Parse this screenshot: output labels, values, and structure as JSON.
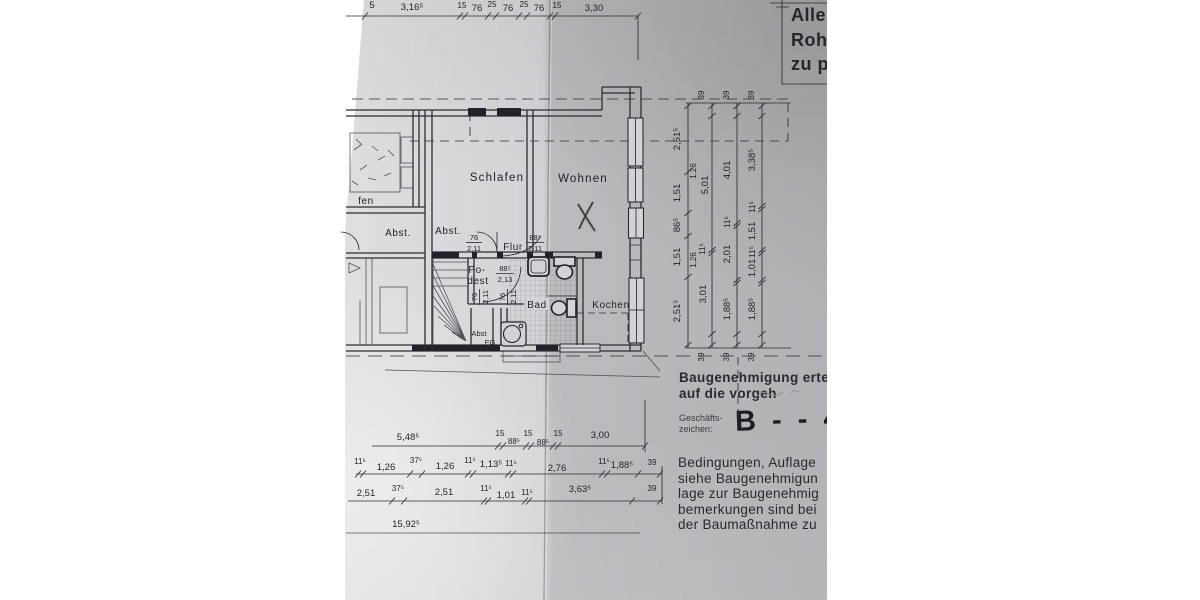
{
  "form_box": {
    "lines": [
      "Alle",
      "Roh",
      "zu p"
    ]
  },
  "plan": {
    "rooms": {
      "schlafen": "Schlafen",
      "wohnen": "Wohnen",
      "flur": "Flur",
      "bad": "Bad",
      "kochen": "Kochen",
      "podest1": "Po-",
      "podest2": "dest",
      "abst_eg": "Abst",
      "eg": "EG",
      "abst_left": "Abst.",
      "abst_mid": "Abst.",
      "schlafen_cut": "fen"
    },
    "doors": [
      {
        "w": "76",
        "h": "2,11"
      },
      {
        "w": "88⁵",
        "h": "2,11"
      },
      {
        "w": "88⁵",
        "h": "2,13"
      },
      {
        "w": "76",
        "h": "2,11"
      },
      {
        "w": "76",
        "h": "2,11"
      }
    ]
  },
  "dims": {
    "top_cut": "5",
    "top_chain": [
      "3,16⁵",
      "15",
      "76",
      "25",
      "76",
      "25",
      "76",
      "15",
      "3,30"
    ],
    "right": {
      "a": [
        "2,51⁵",
        "1,51",
        "86⁵",
        "1,51",
        "2,51⁵"
      ],
      "b": [
        "39",
        "5,01",
        "11⁵",
        "3,01",
        "39"
      ],
      "b_aux": [
        "1,26",
        "1,26"
      ],
      "c": [
        "39",
        "4,01",
        "11⁵",
        "2,01",
        "1,88⁵",
        "39"
      ],
      "d": [
        "39",
        "3,38⁵",
        "11⁵",
        "1,51",
        "11⁵",
        "1,01",
        "1,88⁵",
        "39"
      ]
    },
    "row1": [
      "5,48⁵",
      "15",
      "88⁵",
      "15",
      "88⁵",
      "15",
      "3,00"
    ],
    "row2": [
      "11⁵",
      "1,26",
      "37⁵",
      "1,26",
      "11⁵",
      "1,13⁵",
      "11⁵",
      "2,76",
      "11⁵",
      "1,88⁵",
      "39"
    ],
    "row3": [
      "2,51",
      "37⁵",
      "2,51",
      "11⁵",
      "1,01",
      "11⁵",
      "3,63⁵",
      "39"
    ],
    "total": "15,92⁵"
  },
  "stamp": {
    "line1": "Baugenehmigung erteil",
    "line2": "auf die vorgeh",
    "gz1": "Geschäfts-",
    "gz2": "zeichen:",
    "gz_value": "B - - 4",
    "conditions": [
      "Bedingungen, Auflage",
      "siehe Baugenehmigun",
      "lage zur Baugenehmig",
      "bemerkungen sind bei",
      "der Baumaßnahme zu"
    ]
  },
  "colors": {
    "paper": "#d0d1d4",
    "ink": "#2c2c33",
    "shadow": "#b9bac0"
  }
}
